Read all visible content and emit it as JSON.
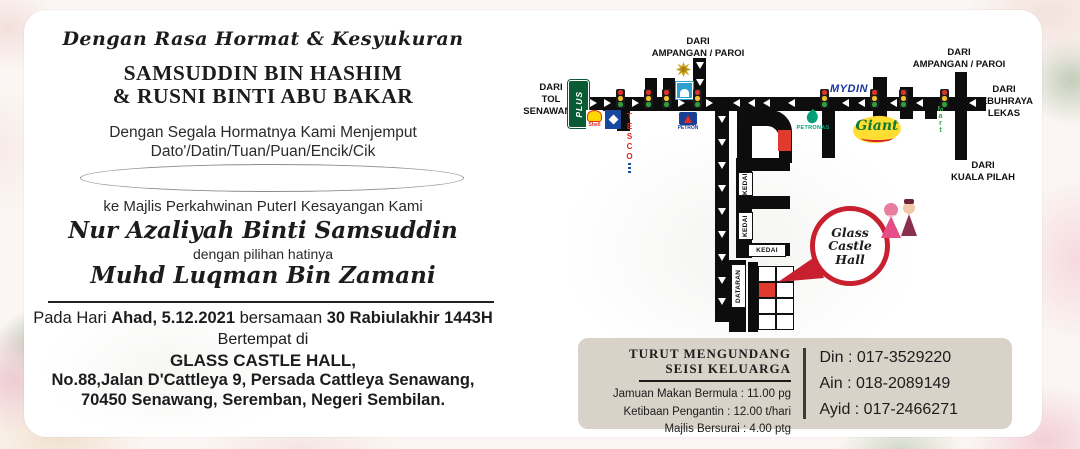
{
  "invitation": {
    "opening": "Dengan Rasa Hormat & Kesyukuran",
    "parents_line1": "SAMSUDDIN BIN HASHIM",
    "parents_line2": "& RUSNI BINTI ABU BAKAR",
    "invite_line": "Dengan Segala Hormatnya Kami Menjemput",
    "honorifics": "Dato'/Datin/Tuan/Puan/Encik/Cik",
    "guest_name_value": "",
    "event_line": "ke Majlis Perkahwinan PuterI Kesayangan Kami",
    "bride_name": "Nur Azaliyah Binti Samsuddin",
    "with_choice": "dengan pilihan hatinya",
    "groom_name": "Muhd Luqman Bin Zamani",
    "date_prefix": "Pada Hari ",
    "date_bold": "Ahad, 5.12.2021",
    "date_mid": " bersamaan ",
    "date_hijri": "30 Rabiulakhir 1443H",
    "venue_intro": "Bertempat di",
    "venue_name": "GLASS CASTLE HALL,",
    "venue_addr1": "No.88,Jalan D'Cattleya 9, Persada Cattleya Senawang,",
    "venue_addr2": "70450 Senawang, Seremban, Negeri Sembilan."
  },
  "schedule_box": {
    "heading_line1": "TURUT MENGUNDANG",
    "heading_line2": "SEISI KELUARGA",
    "items": [
      "Jamuan Makan Bermula : 11.00 pg",
      "Ketibaan Pengantin : 12.00 t/hari",
      "Majlis Bersurai : 4.00 ptg"
    ],
    "contacts": [
      "Din : 017-3529220",
      "Ain : 018-2089149",
      "Ayid : 017-2466271"
    ]
  },
  "map": {
    "directions": {
      "toll": "DARI\nTOL\nSENAWANG",
      "ampangan_left": "DARI\nAMPANGAN / PAROI",
      "ampangan_right": "DARI\nAMPANGAN / PAROI",
      "lekas": "DARI\nLEBUHRAYA\nLEKAS",
      "kuala_pilah": "DARI\nKUALA PILAH"
    },
    "logos": {
      "plus": "PLUS",
      "shell": "Shell",
      "tesco": "TESCO",
      "petron": "PETRON",
      "petronas": "PETRONAS",
      "mydin": "MYDIN",
      "giant": "Giant",
      "mart": "Mart"
    },
    "shop_label": "KEDAI",
    "square_label": "DATARAN",
    "balloon": {
      "line1": "Glass",
      "line2": "Castle",
      "line3": "Hall"
    }
  },
  "colors": {
    "balloon_red": "#c8202f",
    "marker_red": "#e0392e",
    "road_black": "#0d0d0d",
    "box_taupe": "#d8d2c8"
  }
}
